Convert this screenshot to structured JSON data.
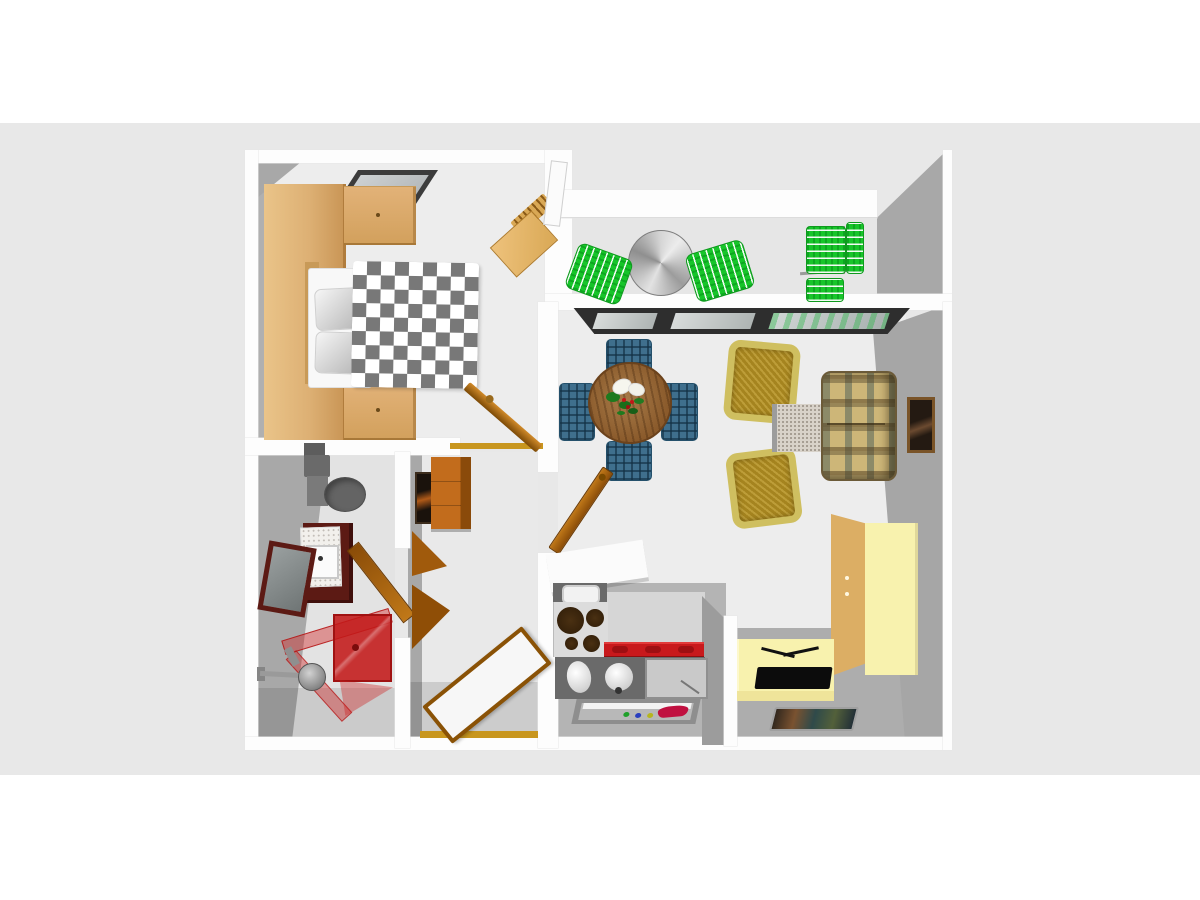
{
  "scene": {
    "description": "3D top-down rendering of a one-bedroom apartment floor plan",
    "view": "top-down perspective",
    "visible_text": []
  },
  "palette": {
    "bg-band": "#e8e8e8",
    "wall": "#fdfdfd",
    "wall-face": "#a8a8a8",
    "floor-light": "#ededed",
    "floor-shadow": "#b4b4b4",
    "wood": "#ddb074",
    "wood-dark": "#c08848",
    "duvet-gray": "#787878",
    "cream": "#f8f2ae",
    "tan": "#dcae64",
    "orange": "#c26c1c",
    "door-brown": "#a05a0c",
    "threshold": "#c8961e",
    "green": "#17c52a",
    "table-wood": "#8a5a2b",
    "plaid-blue": "#3f6f8d",
    "olive": "#a5841f",
    "olive-rim": "#cfbf60",
    "sofa-tan": "#cdb678",
    "red": "#c8191c",
    "shower-red": "#cd2323",
    "maroon": "#5c1a14",
    "appliance-gray": "#6a6a6a"
  },
  "rooms": [
    {
      "name": "bedroom",
      "furniture": [
        "wardrobe with overbed cabinets",
        "double bed with checkered duvet and two pillows",
        "skylight window",
        "wooden desk and chair",
        "interior door",
        "threshold"
      ]
    },
    {
      "name": "balcony",
      "furniture": [
        "round metal bistro table",
        "two green folding chairs",
        "green folding lounger",
        "white balcony door"
      ]
    },
    {
      "name": "living-room",
      "furniture": [
        "window band",
        "round wooden dining table",
        "four blue plaid dining chairs",
        "flower centerpiece",
        "two olive armchairs",
        "speckled side table",
        "plaid sofa",
        "framed wall picture",
        "cream wardrobe",
        "tv cabinet with television",
        "doormat",
        "interior door"
      ]
    },
    {
      "name": "kitchen",
      "furniture": [
        "white counter peninsula",
        "sink unit",
        "cooktop with four burners",
        "red base cabinets",
        "counter with jug and kettle",
        "appliance front panel",
        "serving tray with utensils"
      ]
    },
    {
      "name": "bathroom",
      "furniture": [
        "toilet with cistern",
        "maroon vanity with washbasin",
        "maroon framed mirror",
        "red glass shower enclosure",
        "shower head set",
        "interior door"
      ]
    },
    {
      "name": "hallway",
      "furniture": [
        "framed picture",
        "orange tall cabinet",
        "open interior door leaves",
        "entrance door",
        "entrance threshold"
      ]
    }
  ]
}
